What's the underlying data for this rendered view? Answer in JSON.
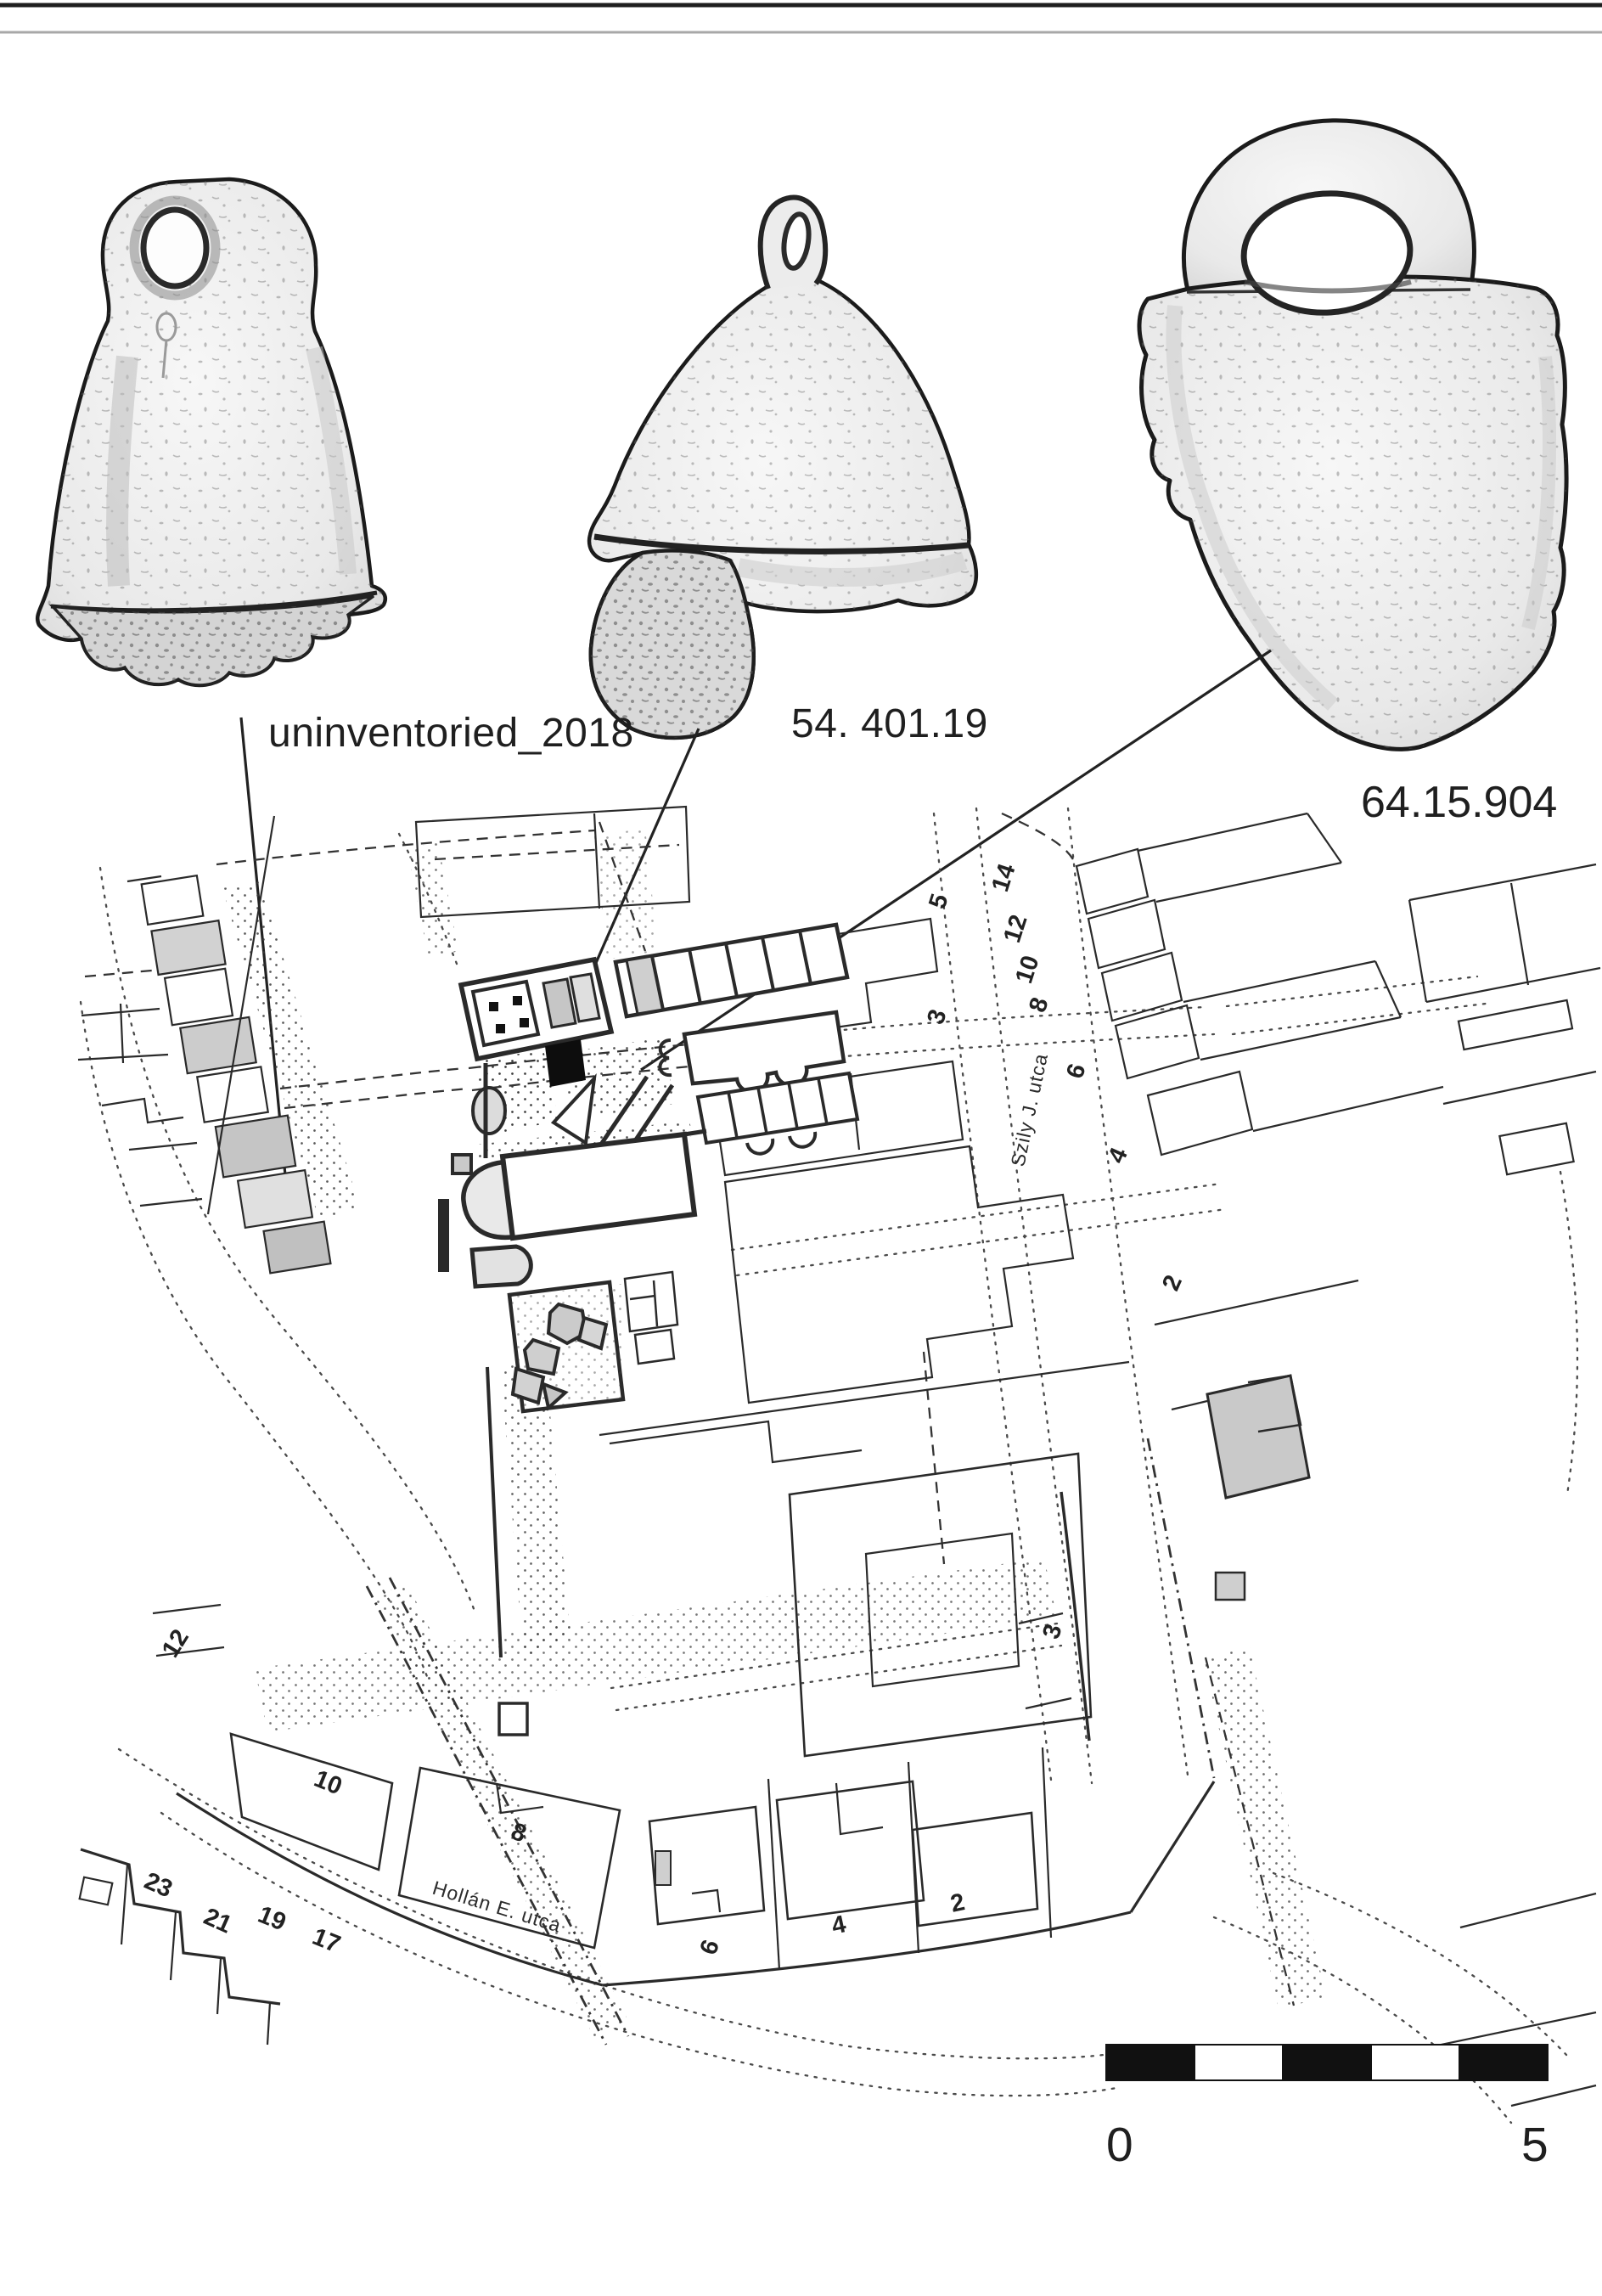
{
  "artifacts": {
    "labels": [
      "uninventoried_2018",
      "54. 401.19",
      "64.15.904"
    ]
  },
  "map": {
    "street_labels": {
      "szily": "Szily J. utca",
      "hollan": "Hollán E. utca"
    },
    "szily_east_numbers": [
      "14",
      "12",
      "10",
      "8",
      "6",
      "4",
      "2"
    ],
    "szily_west_numbers": [
      "5",
      "3",
      "3"
    ],
    "hollan_numbers": [
      "10",
      "8"
    ],
    "corner_numbers": [
      "23",
      "21",
      "19",
      "17"
    ],
    "south_numbers": [
      "6",
      "4",
      "2"
    ],
    "west_number": "12"
  },
  "scale_bar": {
    "zero": "0",
    "five": "5"
  },
  "colors": {
    "ink": "#2a2a2a",
    "bar_dark": "#111111",
    "bar_light": "#ffffff",
    "artifact_fill": "#e8e8e8"
  }
}
